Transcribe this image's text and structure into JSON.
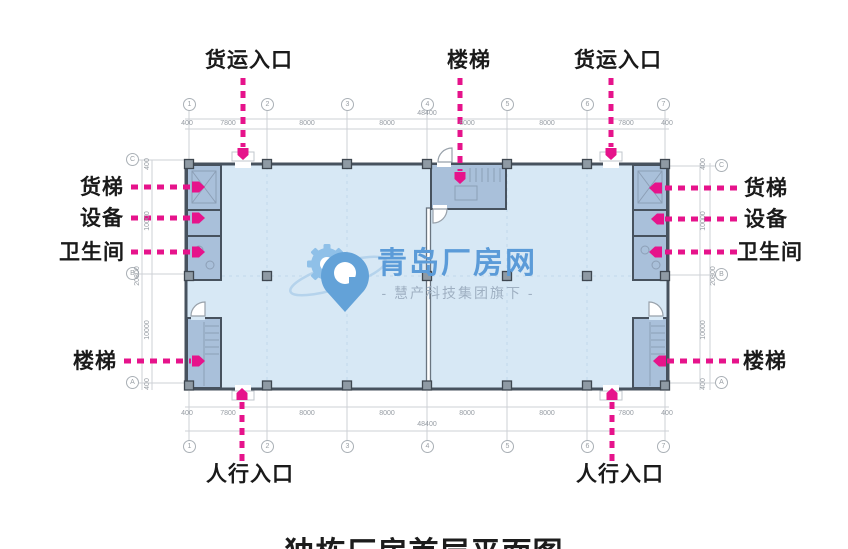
{
  "title": "独栋厂房首层平面图",
  "watermark": {
    "brand": "青岛厂房网",
    "subtitle": "- 慧产科技集团旗下 -",
    "brand_color": "#5b9bd8",
    "subtitle_color": "#9fb0c2"
  },
  "callouts": {
    "freight_entrance_left": "货运入口",
    "stairs_top": "楼梯",
    "freight_entrance_right": "货运入口",
    "freight_elevator_left": "货梯",
    "equipment_left": "设备",
    "restroom_left": "卫生间",
    "stairs_left": "楼梯",
    "freight_elevator_right": "货梯",
    "equipment_right": "设备",
    "restroom_right": "卫生间",
    "stairs_right": "楼梯",
    "pedestrian_entrance_left": "人行入口",
    "pedestrian_entrance_right": "人行入口"
  },
  "grid": {
    "columns": [
      "1",
      "2",
      "3",
      "4",
      "5",
      "6",
      "7"
    ],
    "rows": [
      "C",
      "B",
      "A"
    ]
  },
  "dims": {
    "top_segments": [
      "400",
      "7800",
      "8000",
      "8000",
      "8000",
      "8000",
      "7800",
      "400"
    ],
    "top_total": "48400",
    "bottom_segments": [
      "400",
      "7800",
      "8000",
      "8000",
      "8000",
      "8000",
      "7800",
      "400"
    ],
    "bottom_total": "48400",
    "left_segments": [
      "400",
      "10000",
      "10000",
      "400"
    ],
    "left_total": "20800",
    "right_segments": [
      "400",
      "10000",
      "10000",
      "400"
    ],
    "right_total": "20800"
  },
  "colors": {
    "accent_magenta": "#e6138b",
    "floor_fill": "#d7e8f5",
    "room_fill": "#a9c0da",
    "wall": "#47525e",
    "dim_gray": "#c6cace"
  }
}
